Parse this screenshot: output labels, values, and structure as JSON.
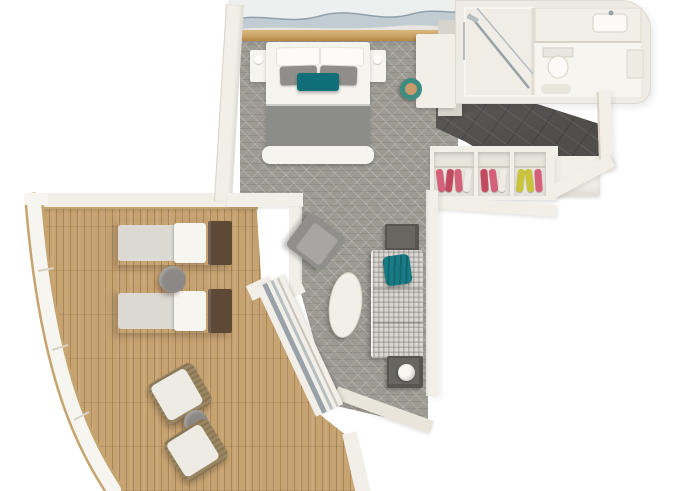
{
  "canvas": {
    "width": 680,
    "height": 491,
    "background": "#ffffff"
  },
  "scene": {
    "type": "3d-floorplan-render",
    "description": "Top-down 3D rendering of a ship suite with bedroom, bathroom, entry hall with wardrobe, living room and large curved balcony deck",
    "rooms": [
      {
        "id": "bedroom",
        "label": "Bedroom",
        "furniture": [
          "double-bed",
          "white-pillows",
          "gray-pillows",
          "teal-accent-pillow",
          "gray-blanket",
          "foot-bench",
          "nightstand-left",
          "nightstand-right",
          "headboard-artwork",
          "gold-trim-shelf",
          "vanity-desk",
          "vanity-stool",
          "wall-tv-panel",
          "patterned-carpet"
        ]
      },
      {
        "id": "bathroom",
        "label": "Bathroom",
        "furniture": [
          "shower",
          "glass-partition",
          "vanity-counter",
          "sink",
          "toilet",
          "bath-mat",
          "shelf"
        ]
      },
      {
        "id": "entry-hall",
        "label": "Entry Hall",
        "furniture": [
          "dark-tile-floor",
          "wardrobe-cubby-1",
          "wardrobe-cubby-2",
          "wardrobe-cubby-3",
          "hanging-clothes",
          "luggage-bench"
        ]
      },
      {
        "id": "living-room",
        "label": "Living Room",
        "furniture": [
          "sofa",
          "teal-throw",
          "armchair",
          "oval-coffee-table",
          "side-table-upper",
          "side-table-lower",
          "table-lamp",
          "sliding-glass-door",
          "patterned-carpet"
        ]
      },
      {
        "id": "balcony-deck",
        "label": "Balcony Deck",
        "furniture": [
          "sun-lounger-1",
          "sun-lounger-2",
          "round-deck-table-upper",
          "wicker-chair-1",
          "wicker-chair-2",
          "round-deck-table-lower",
          "curved-railing",
          "teak-decking"
        ]
      }
    ]
  },
  "palette": {
    "bg": "#ffffff",
    "wall": "#f2efe8",
    "wall-shade": "#e9e5db",
    "wall-edge": "#d9d3c6",
    "carpet": "#9d9a93",
    "deck-wood": "#c7a372",
    "deck-table": "#8b8885",
    "railing-white": "#f7f5f0",
    "railing-trim": "#c5a470",
    "dark-floor": "#504e4b",
    "linen-white": "#f6f4ef",
    "pillow-white": "#fcfbf8",
    "pillow-gray": "#8f8e8b",
    "accent-teal": "#0f6e78",
    "blanket-gray": "#8c8c89",
    "sofa-fabric": "#d9d6d1",
    "throw-teal": "#177b86",
    "table-dark": "#585551",
    "lamp-white": "#f8f6f1",
    "armchair-gray": "#918f8b",
    "armchair-seat": "#a8a6a2",
    "stool-ring": "#3f8d82",
    "stool-top": "#c99a6a",
    "wicker": "#9b8662",
    "chair-cushion": "#edebe4",
    "lounger-cushion": "#dcd9d2",
    "lounger-wood": "#5d4936",
    "clothes-pink": "#d4607a",
    "clothes-red": "#c24a60",
    "clothes-yellow": "#c9c43a",
    "gold-trim": "#c9a265",
    "art-base": "#eef0f0",
    "art-wave": "#c2cdd3",
    "art-wave-dark": "#8fa0ab",
    "glass": "#98a2a8",
    "chrome": "#b6bec2",
    "bath-shell": "#eeebe4",
    "bath-floor": "#f7f5ef",
    "fixture-white": "#fbfaf6",
    "fixture-edge": "#d5d0c5",
    "tv-dark": "#6e6b66"
  }
}
